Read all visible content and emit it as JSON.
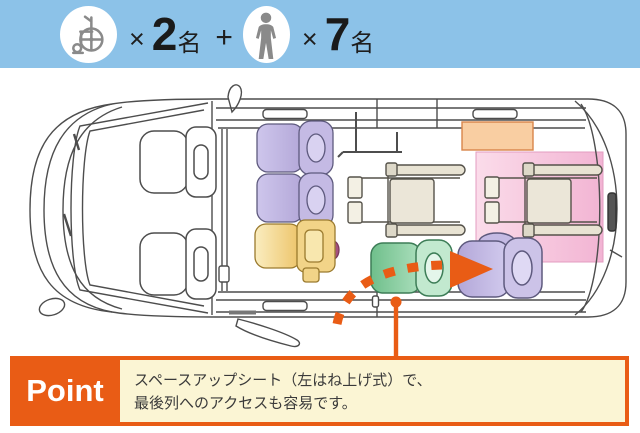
{
  "capacity_bar": {
    "bar_color": "#8CC2E8",
    "wheelchair_icon": "wheelchair-icon",
    "wheelchair_times": "×",
    "wheelchair_count": "2",
    "wheelchair_unit": "名",
    "plus": "+",
    "person_icon": "person-icon",
    "person_times": "×",
    "person_count": "7",
    "person_unit": "名"
  },
  "diagram": {
    "kind": "van-seating-top-view",
    "colors": {
      "outline": "#4d4d4d",
      "seat_purple": "#C0B5E0",
      "seat_yellow": "#F0CB74",
      "seat_green": "#84CA9B",
      "wheelchair_beige": "#EBE6D8",
      "wheelchair_zone_pink": "#F6C3DC",
      "rear_panel_peach": "#F9CEA2",
      "arrow_orange": "#E95C15"
    }
  },
  "point": {
    "label": "Point",
    "line1": "スペースアップシート（左はね上げ式）で、",
    "line2": "最後列へのアクセスも容易です。",
    "label_bg": "#E95C15",
    "box_bg": "#FBF5D4"
  }
}
